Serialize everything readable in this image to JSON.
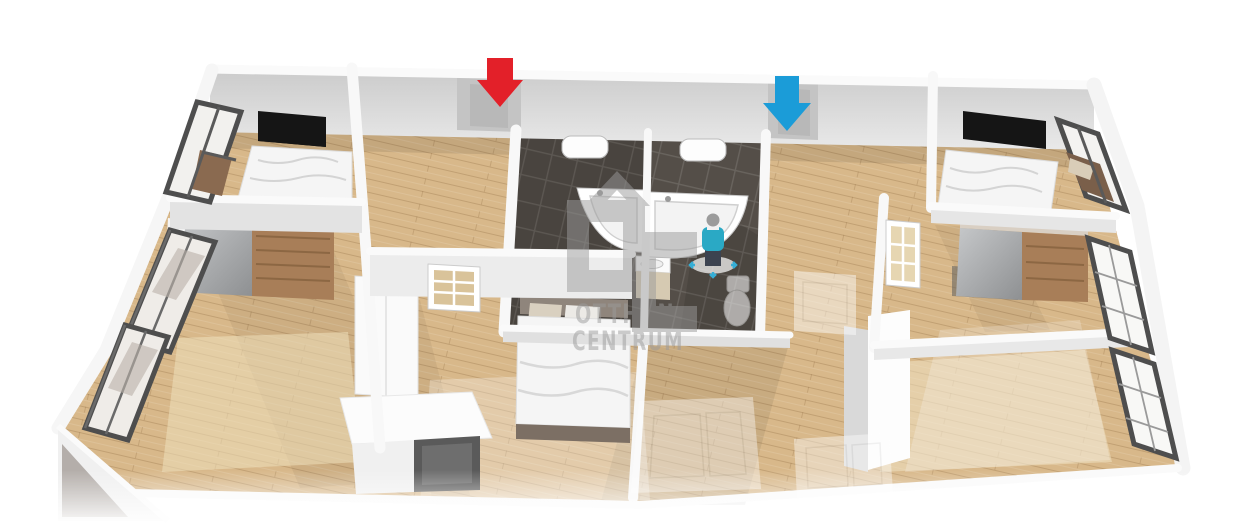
{
  "scene": {
    "description": "3D perspective floor plan render of an apartment",
    "watermark": {
      "logo_text": "OC",
      "line1": "OTTHON",
      "line2": "CENTRUM"
    },
    "markers": {
      "red_arrow": {
        "shape": "arrow-down",
        "color": "#e32029",
        "points_at": "left entrance doorway"
      },
      "blue_arrow": {
        "shape": "arrow-down",
        "color": "#1b9cd8",
        "points_at": "right entrance doorway"
      }
    },
    "figure": {
      "type": "person",
      "sweater_color": "#2aa9c5",
      "pants_color": "#3c4350",
      "head_color": "#9b9b9b"
    },
    "palette": {
      "wood_floor": "#d8b88a",
      "tile_floor": "#544e48",
      "wall_top": "#fafafa",
      "wall_face": "#d8d8d8",
      "wall_face_light": "#ececec",
      "tv_black": "#151515",
      "window_frame": "#4e4e4e",
      "furniture_wood": "#a87e58",
      "door_wood": "#99714e",
      "mirror_gray": "#b3b3b3",
      "duvet_white": "#f5f5f5",
      "watermark_gray": "#9b9b9b"
    },
    "rooms": [
      {
        "name": "bedroom-top-left",
        "furniture": [
          "bed",
          "tv",
          "window",
          "armchair"
        ]
      },
      {
        "name": "entrance-hall",
        "furniture": []
      },
      {
        "name": "bathroom-left",
        "furniture": [
          "corner-bathtub",
          "washbasin",
          "mirror"
        ]
      },
      {
        "name": "bathroom-right",
        "furniture": [
          "corner-bathtub",
          "toilet",
          "mirror",
          "person-figure"
        ]
      },
      {
        "name": "hallway-right",
        "furniture": [
          "ghost-cabinet"
        ]
      },
      {
        "name": "bedroom-top-right",
        "furniture": [
          "bed",
          "tv",
          "window",
          "armchair"
        ]
      },
      {
        "name": "living-room-left",
        "furniture": [
          "sliding-wardrobe",
          "windows",
          "rug"
        ]
      },
      {
        "name": "bedroom-center",
        "furniture": [
          "double-bed",
          "wardrobe",
          "cabinet",
          "glass-door"
        ]
      },
      {
        "name": "room-center-right",
        "furniture": [
          "ghost-rug"
        ]
      },
      {
        "name": "room-right-middle",
        "furniture": [
          "sliding-wardrobe",
          "glass-door",
          "wood-door-panel"
        ]
      },
      {
        "name": "living-room-right",
        "furniture": [
          "tall-cabinet",
          "windows",
          "rug",
          "ghost-cabinet"
        ]
      }
    ]
  }
}
